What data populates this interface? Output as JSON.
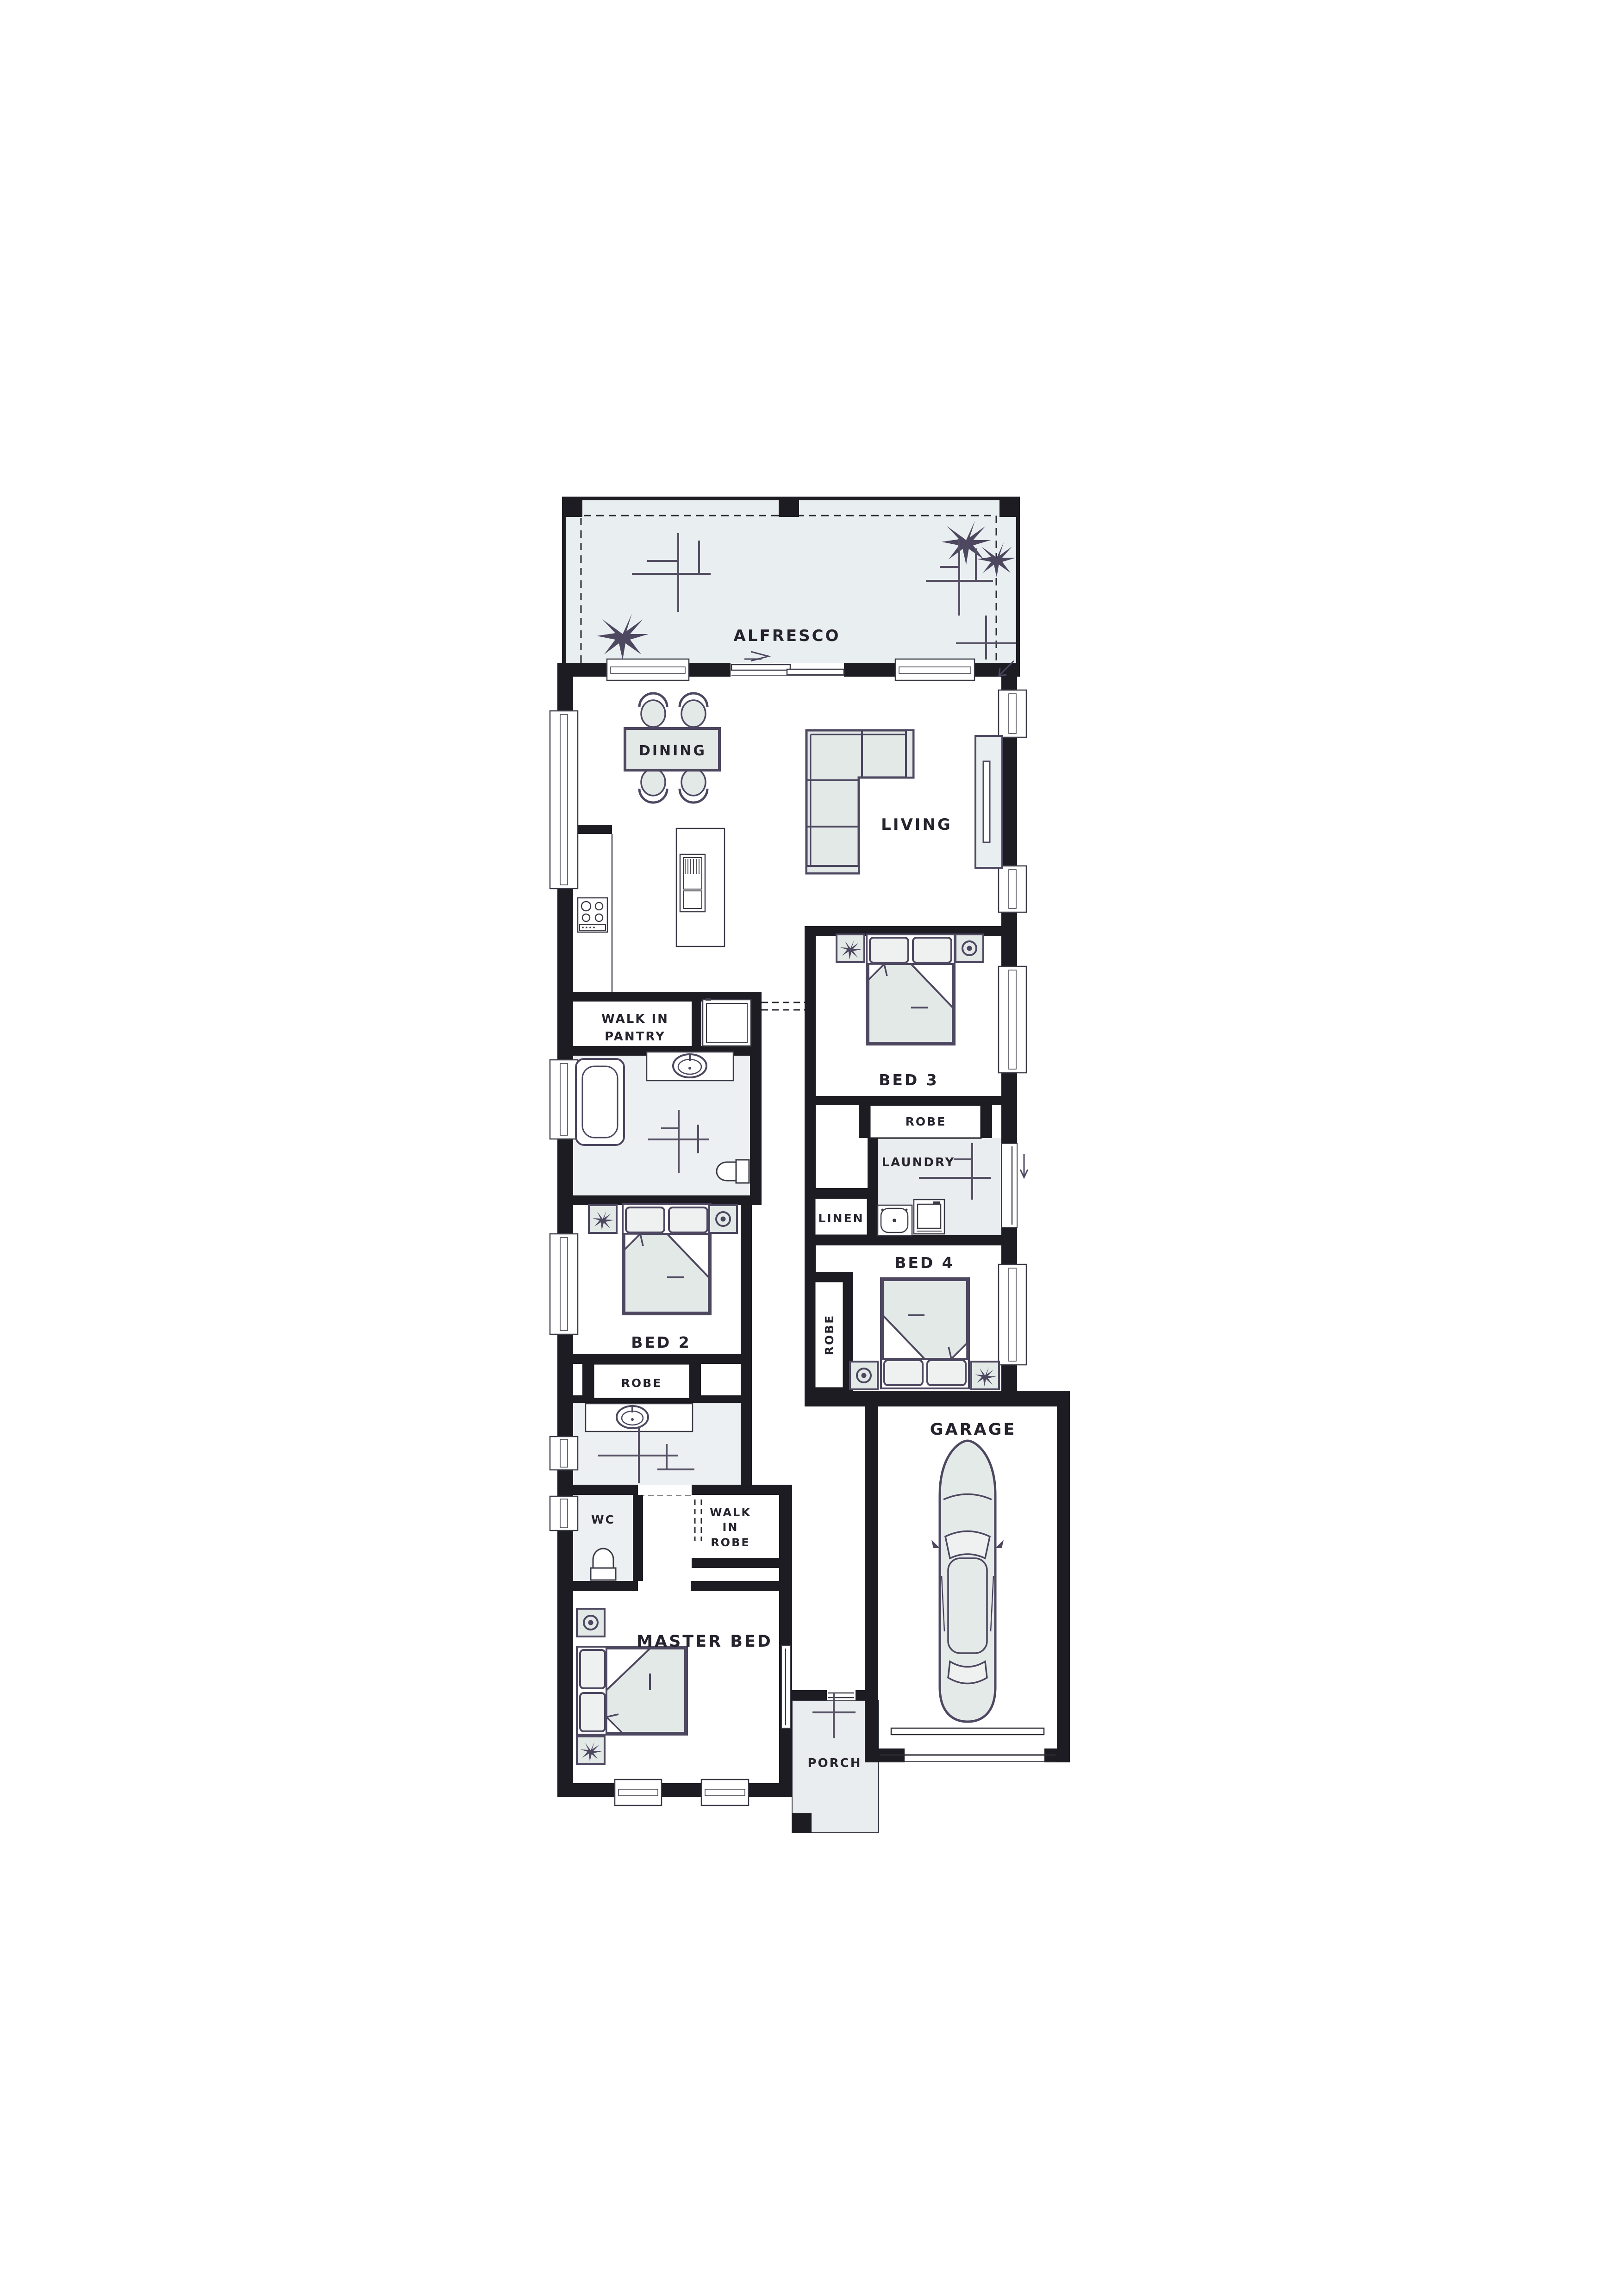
{
  "plan": {
    "type": "single-storey house floor plan",
    "colors": {
      "wall": "#1d1c23",
      "furniture_stroke": "#4d4760",
      "furniture_fill": "#e3e9e7",
      "floor_tint": "#e9eef0",
      "wet_area_tint": "#edf0f2",
      "text": "#26232e",
      "background": "#ffffff"
    },
    "rooms": {
      "alfresco": {
        "label": "ALFRESCO"
      },
      "dining": {
        "label": "DINING"
      },
      "living": {
        "label": "LIVING"
      },
      "walk_in_pantry": {
        "line1": "WALK IN",
        "line2": "PANTRY"
      },
      "bed3": {
        "label": "BED 3"
      },
      "robe_bed3": {
        "label": "ROBE"
      },
      "laundry": {
        "label": "LAUNDRY"
      },
      "linen": {
        "label": "LINEN"
      },
      "bed4": {
        "label": "BED 4"
      },
      "robe_bed4": {
        "label": "ROBE"
      },
      "bed2": {
        "label": "BED 2"
      },
      "robe_bed2": {
        "label": "ROBE"
      },
      "wc": {
        "label": "WC"
      },
      "walk_in_robe": {
        "line1": "WALK",
        "line2": "IN",
        "line3": "ROBE"
      },
      "master_bed": {
        "label": "MASTER BED"
      },
      "garage": {
        "label": "GARAGE"
      },
      "porch": {
        "label": "PORCH"
      }
    }
  }
}
